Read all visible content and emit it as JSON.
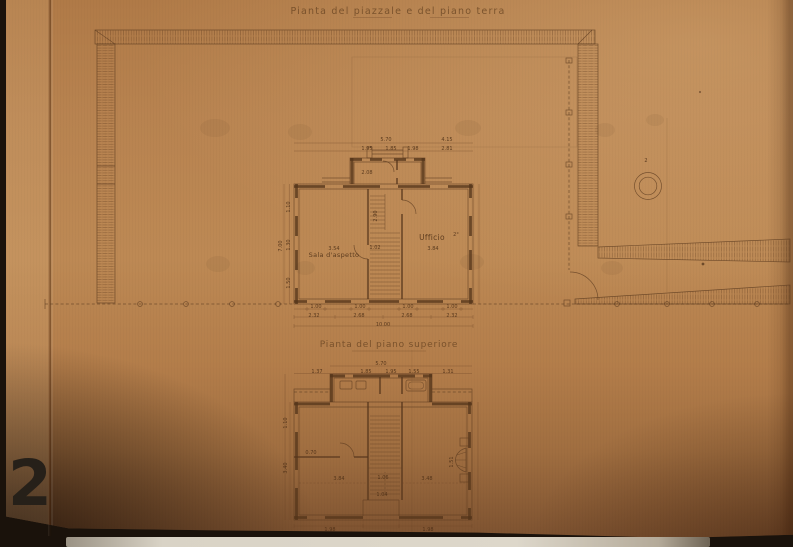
{
  "titles": {
    "ground": "Pianta del piazzale e del piano terra",
    "upper": "Pianta del piano superiore"
  },
  "rooms": {
    "sala": "Sala d'aspetto",
    "ufficio": "Ufficio"
  },
  "well": {
    "mark": "2"
  },
  "photo": {
    "page_number": "2"
  },
  "colors": {
    "paper": "#b9834f",
    "ink": "#5a3b20",
    "page_number": "#262019",
    "table_strip": "#d8d1c3"
  },
  "annotations": [
    {
      "x": 386,
      "y": 141,
      "t": "5.70"
    },
    {
      "x": 447,
      "y": 141,
      "t": "4.15"
    },
    {
      "x": 367,
      "y": 150,
      "t": "1.95"
    },
    {
      "x": 391,
      "y": 150,
      "t": "1.85"
    },
    {
      "x": 413,
      "y": 150,
      "t": "1.98"
    },
    {
      "x": 447,
      "y": 150,
      "t": "2.81"
    },
    {
      "x": 367,
      "y": 174,
      "t": "2.08",
      "o": 0.75
    },
    {
      "x": 282,
      "y": 246,
      "t": "7.00",
      "r": -90
    },
    {
      "x": 290,
      "y": 207,
      "t": "1.10",
      "r": -90
    },
    {
      "x": 290,
      "y": 245,
      "t": "1.30",
      "r": -90
    },
    {
      "x": 290,
      "y": 283,
      "t": "1.50",
      "r": -90
    },
    {
      "x": 334,
      "y": 250,
      "t": "3.54"
    },
    {
      "x": 375,
      "y": 249,
      "t": "1.02"
    },
    {
      "x": 433,
      "y": 250,
      "t": "3.84"
    },
    {
      "x": 377,
      "y": 216,
      "t": "2.90",
      "r": -90
    },
    {
      "x": 456,
      "y": 236,
      "t": "2°",
      "s": 4.5
    },
    {
      "x": 316,
      "y": 308,
      "t": "1.00",
      "s": 4.5
    },
    {
      "x": 360,
      "y": 308,
      "t": "1.00",
      "s": 4.5
    },
    {
      "x": 408,
      "y": 308,
      "t": "1.00",
      "s": 4.5
    },
    {
      "x": 452,
      "y": 308,
      "t": "1.00",
      "s": 4.5
    },
    {
      "x": 314,
      "y": 317,
      "t": "2.32"
    },
    {
      "x": 359,
      "y": 317,
      "t": "2.68"
    },
    {
      "x": 407,
      "y": 317,
      "t": "2.68"
    },
    {
      "x": 452,
      "y": 317,
      "t": "2.32"
    },
    {
      "x": 383,
      "y": 326,
      "t": "10.00"
    },
    {
      "x": 646,
      "y": 162,
      "t": "2",
      "s": 7,
      "o": 0.7
    },
    {
      "x": 381,
      "y": 365,
      "t": "5.70"
    },
    {
      "x": 317,
      "y": 373,
      "t": "1.37"
    },
    {
      "x": 366,
      "y": 373,
      "t": "1.85"
    },
    {
      "x": 391,
      "y": 373,
      "t": "1.95"
    },
    {
      "x": 414,
      "y": 373,
      "t": "1.55"
    },
    {
      "x": 448,
      "y": 373,
      "t": "1.31"
    },
    {
      "x": 287,
      "y": 423,
      "t": "1.10",
      "r": -90
    },
    {
      "x": 287,
      "y": 468,
      "t": "3.40",
      "r": -90
    },
    {
      "x": 311,
      "y": 454,
      "t": "0.70",
      "s": 4.5
    },
    {
      "x": 339,
      "y": 480,
      "t": "3.84"
    },
    {
      "x": 383,
      "y": 479,
      "t": "1.06"
    },
    {
      "x": 427,
      "y": 480,
      "t": "3.48"
    },
    {
      "x": 453,
      "y": 462,
      "t": "1.51",
      "r": -90,
      "s": 4.5
    },
    {
      "x": 382,
      "y": 496,
      "t": "1.04",
      "s": 4.5
    },
    {
      "x": 330,
      "y": 531,
      "t": "1.98",
      "o": 0.5
    },
    {
      "x": 428,
      "y": 531,
      "t": "1.98",
      "o": 0.5
    }
  ]
}
